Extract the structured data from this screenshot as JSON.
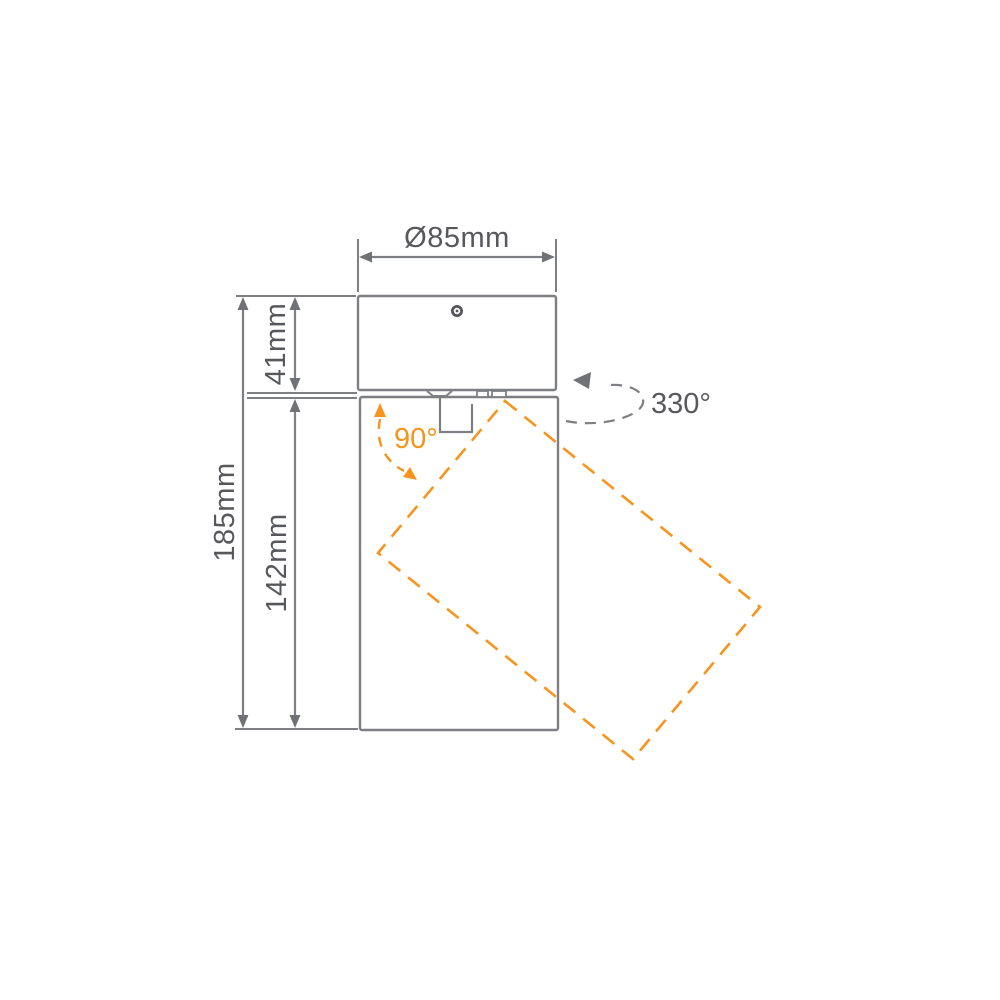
{
  "diagram": {
    "dimensions": {
      "diameter": "Ø85mm",
      "canopy_height": "41mm",
      "body_height": "142mm",
      "total_height": "185mm"
    },
    "rotation": {
      "pan": "330°",
      "tilt": "90°"
    },
    "colors": {
      "line_gray": "#7d7f83",
      "text_gray": "#57585c",
      "accent_orange": "#f7941e",
      "background": "#ffffff"
    }
  }
}
